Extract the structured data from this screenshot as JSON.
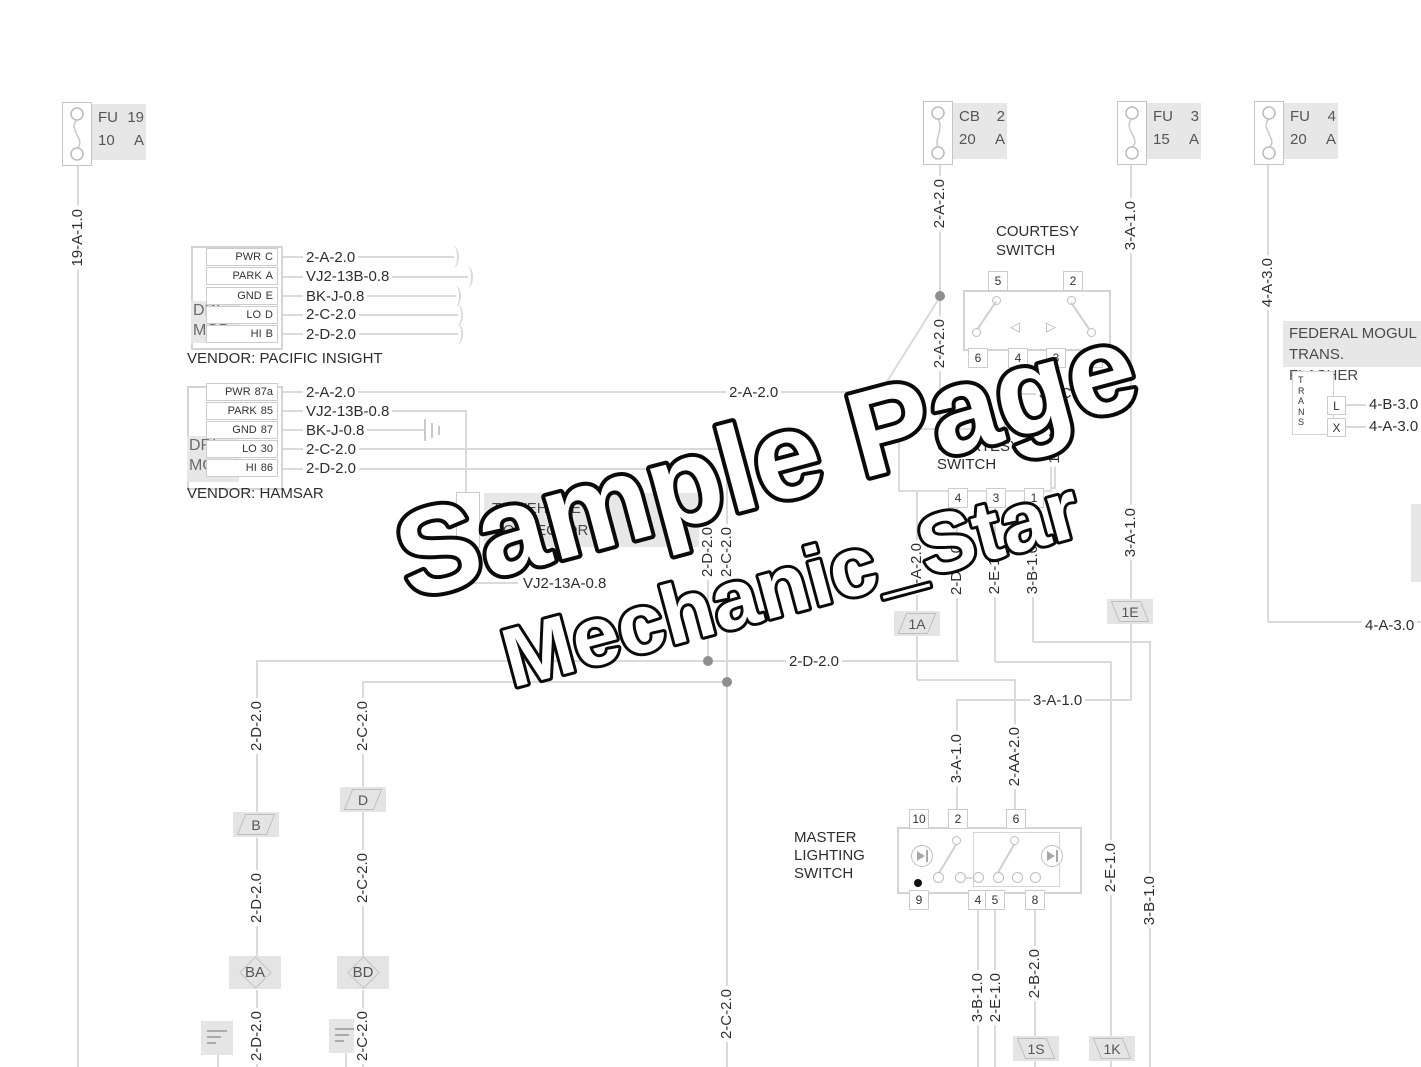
{
  "watermark": {
    "l1": "Sample Page",
    "l2": "Mechanic_Star"
  },
  "wires": {
    "w19a": "19-A-1.0",
    "w2a": "2-A-2.0",
    "w2aa": "2-AA-2.0",
    "w2b": "2-B-2.0",
    "w2c": "2-C-2.0",
    "w2d": "2-D-2.0",
    "w2e": "2-E-1.0",
    "w3a": "3-A-1.0",
    "w3b": "3-B-1.0",
    "w4a": "4-A-3.0",
    "w4b": "4-B-3.0",
    "w35c": "35-C-0.8",
    "w14bk": "14BK",
    "wvj13a": "VJ2-13A-0.8",
    "wvj13b": "VJ2-13B-0.8",
    "wbkj": "BK-J-0.8"
  },
  "fuses": {
    "fu19": {
      "id": "FU",
      "num": "19",
      "amp": "10",
      "unit": "A"
    },
    "cb2": {
      "id": "CB",
      "num": "2",
      "amp": "20",
      "unit": "A"
    },
    "fu3": {
      "id": "FU",
      "num": "3",
      "amp": "15",
      "unit": "A"
    },
    "fu4": {
      "id": "FU",
      "num": "4",
      "amp": "20",
      "unit": "A"
    }
  },
  "drl1": {
    "t1": "DRL",
    "t2": "MOD",
    "vendor": "VENDOR: PACIFIC INSIGHT",
    "p1n": "PWR",
    "p1t": "C",
    "p2n": "PARK",
    "p2t": "A",
    "p3n": "GND",
    "p3t": "E",
    "p4n": "LO",
    "p4t": "D",
    "p5n": "HI",
    "p5t": "B"
  },
  "drl2": {
    "t1": "DRL",
    "t2": "MOD",
    "vendor": "VENDOR: HAMSAR",
    "p1n": "PWR",
    "p1t": "87a",
    "p2n": "PARK",
    "p2t": "85",
    "p3n": "GND",
    "p3t": "87",
    "p4n": "LO",
    "p4t": "30",
    "p5n": "HI",
    "p5t": "86"
  },
  "sw1": {
    "t1": "COURTESY",
    "t2": "SWITCH",
    "p5": "5",
    "p2": "2",
    "p6": "6",
    "p4": "4",
    "p3": "3",
    "p1": "1"
  },
  "sw2": {
    "t1": "COURTESY",
    "t2": "SWITCH",
    "p2": "2",
    "p4": "4",
    "p3": "3",
    "p1": "1"
  },
  "master": {
    "t1": "MASTER",
    "t2": "LIGHTING",
    "t3": "SWITCH",
    "p10": "10",
    "p2": "2",
    "p6": "6",
    "p9": "9",
    "p4": "4",
    "p5": "5",
    "p8": "8"
  },
  "flasher": {
    "t1": "FEDERAL MOGUL",
    "t2": "TRANS. FLASHER",
    "body": "TRANS",
    "pl": "L",
    "px": "X"
  },
  "connectors": {
    "a1": "1A",
    "e1": "1E",
    "b": "B",
    "d": "D",
    "ba": "BA",
    "bd": "BD",
    "s1": "1S",
    "k1": "1K"
  },
  "vehicle": {
    "t1": "TO VEHICLE",
    "t2": "CONNECTOR"
  },
  "icons": {
    "tri_left": "◁",
    "tri_right": "▷"
  }
}
